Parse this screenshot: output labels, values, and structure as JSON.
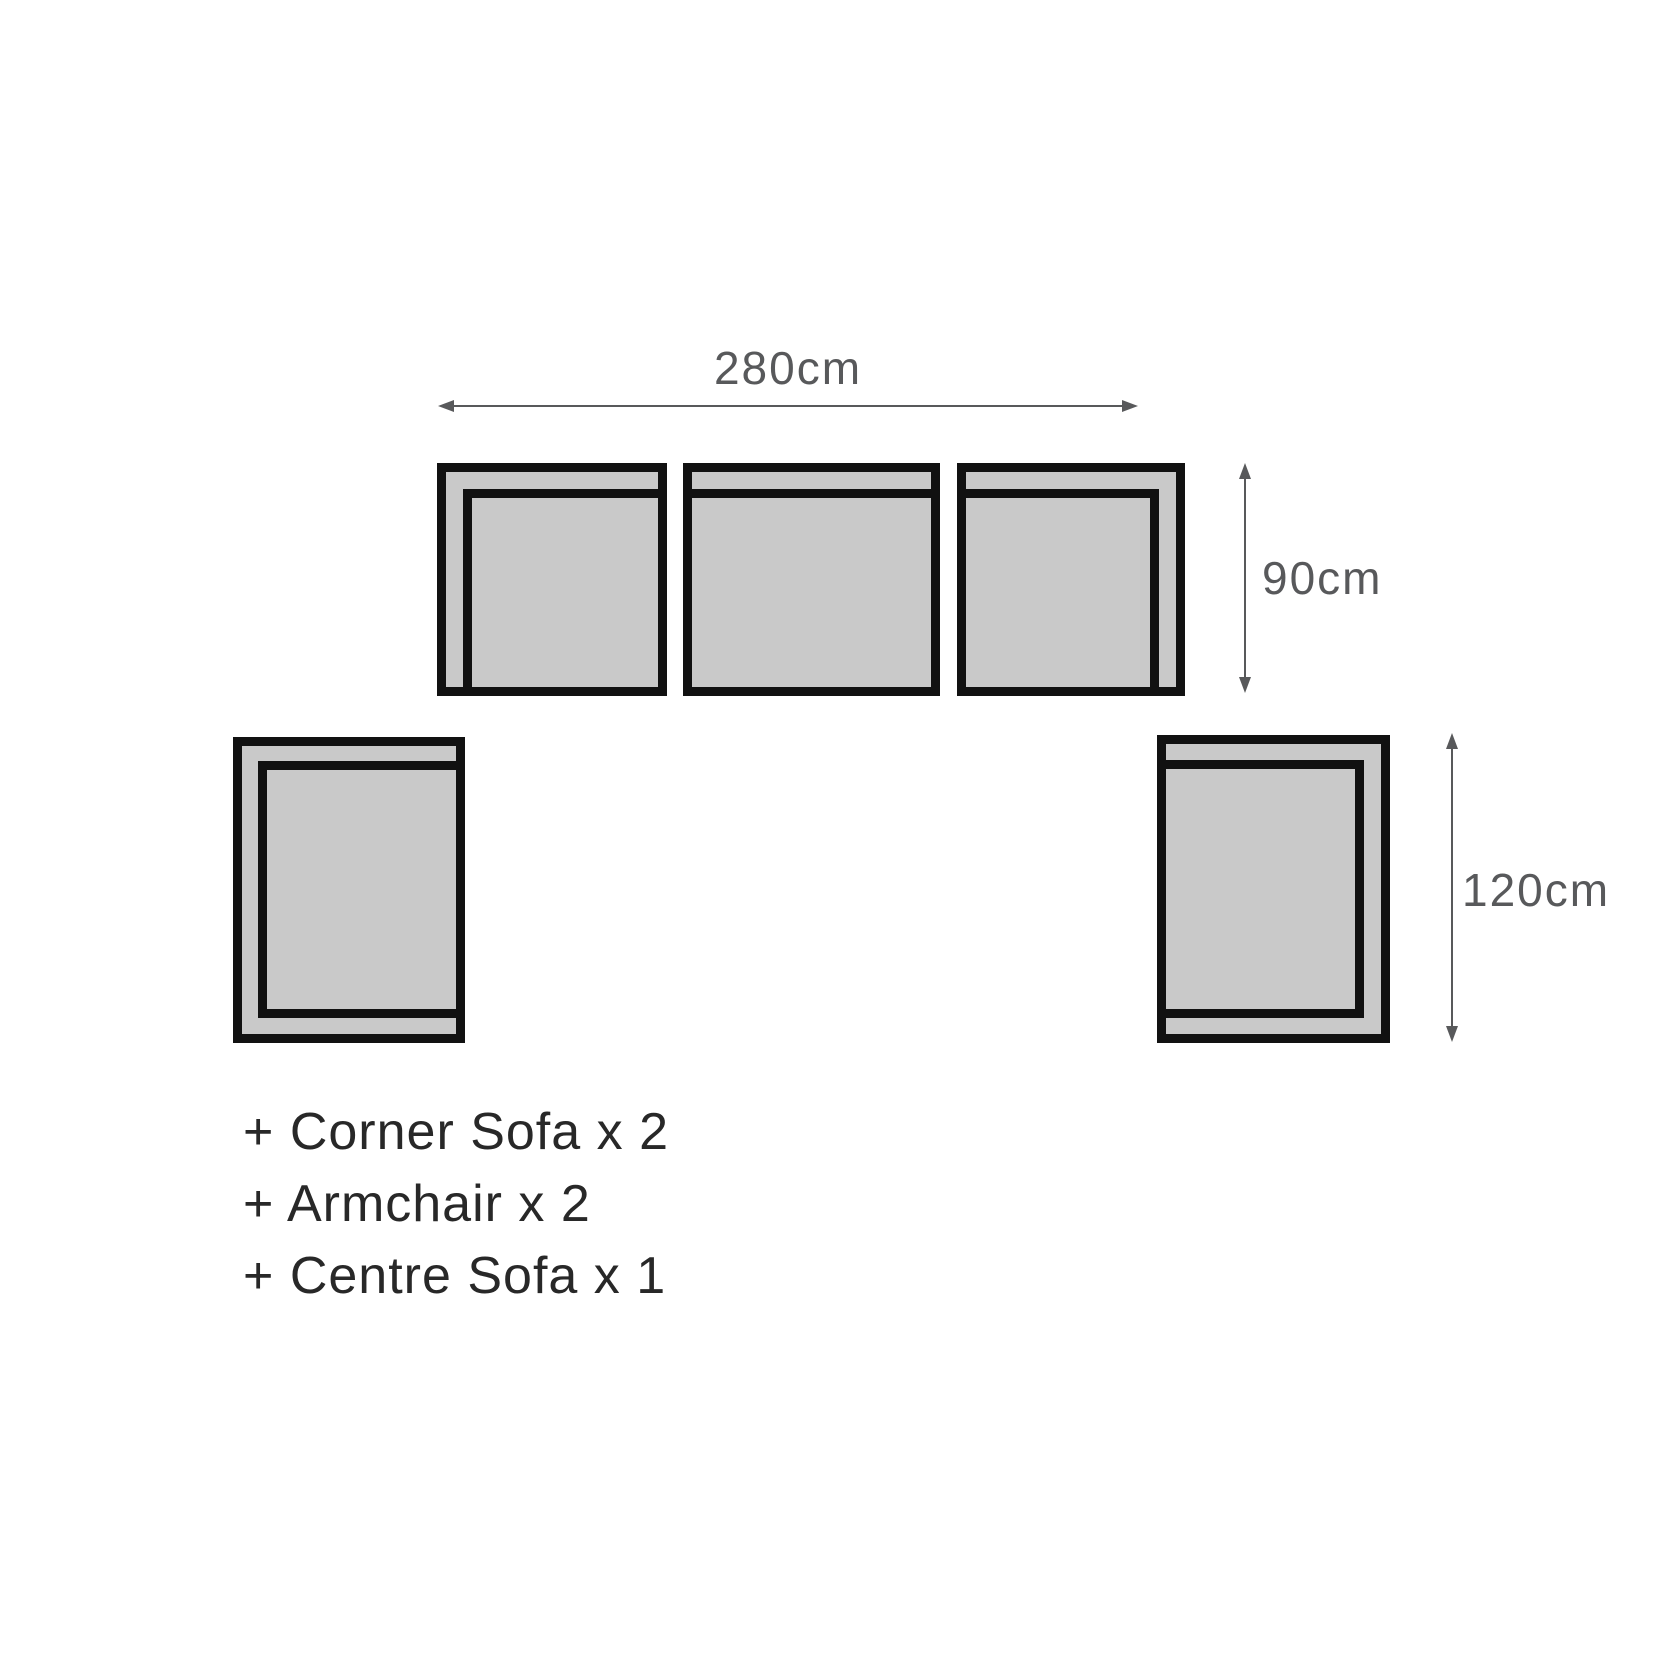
{
  "diagram": {
    "title": "sofa-set-dimension-diagram",
    "dimensions": {
      "width": {
        "label": "280cm"
      },
      "depth": {
        "label": "90cm"
      },
      "side_depth": {
        "label": "120cm"
      }
    },
    "pieces": [
      {
        "name": "corner-sofa-left"
      },
      {
        "name": "centre-sofa"
      },
      {
        "name": "corner-sofa-right"
      },
      {
        "name": "armchair-left"
      },
      {
        "name": "armchair-right"
      }
    ]
  },
  "legend": {
    "items": [
      "+ Corner Sofa x 2",
      "+ Armchair x 2",
      "+ Centre Sofa x 1"
    ]
  },
  "colors": {
    "sofa-fill": "#c9c9c9",
    "outline": "#111111",
    "dim": "#58595b",
    "legend-text": "#282828",
    "bg": "#ffffff"
  }
}
